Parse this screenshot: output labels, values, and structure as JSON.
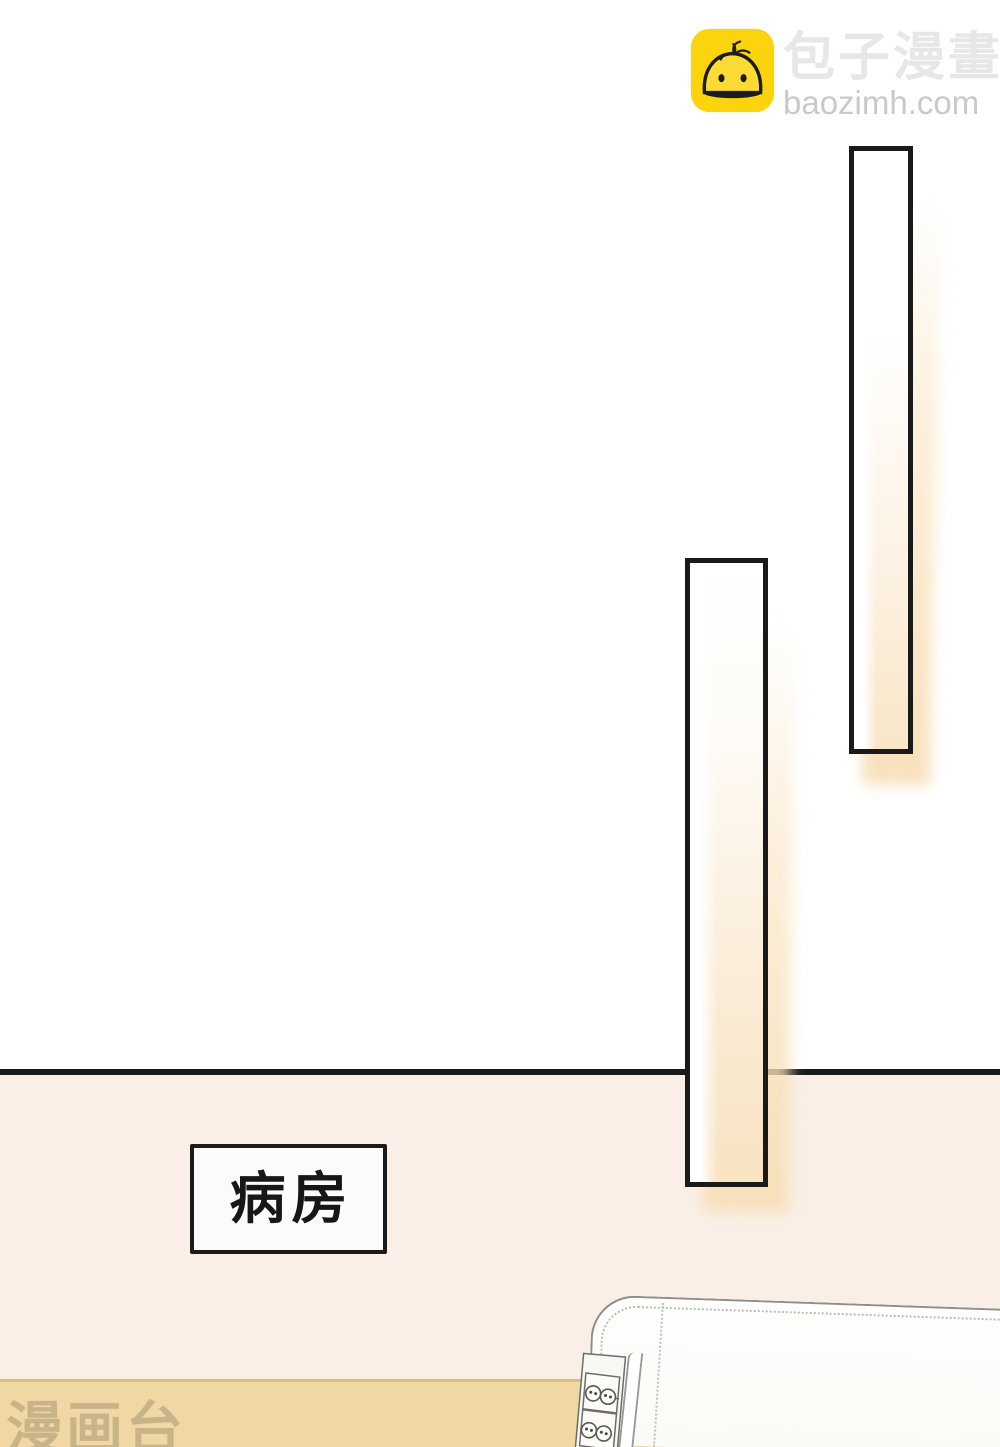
{
  "logo": {
    "site_name": "包子漫畫",
    "site_url": "baozimh.com",
    "icon": "baozi-bun-icon",
    "icon_bg": "#FBD40E",
    "icon_line": "#1C1C1C",
    "name_color": "#E7E7E7",
    "url_color": "#C9C9C9"
  },
  "scene": {
    "ward_sign_label": "病房",
    "watermark_text": "漫画台",
    "elements": {
      "door_frames": 2,
      "outlet_plates": 2,
      "sockets_per_plate": 2
    },
    "colors": {
      "upper_wall": "#FFFFFF",
      "lower_wall": "#F9EFE7",
      "wainscot_band": "#F0D7A3",
      "wainscot_edge": "#DCBE7D",
      "outline_black": "#1A1A1A",
      "frame_glow": "#F8DFB7",
      "headboard_white": "#FDFDFB",
      "watermark_color": "rgba(148,131,104,0.42)"
    }
  }
}
